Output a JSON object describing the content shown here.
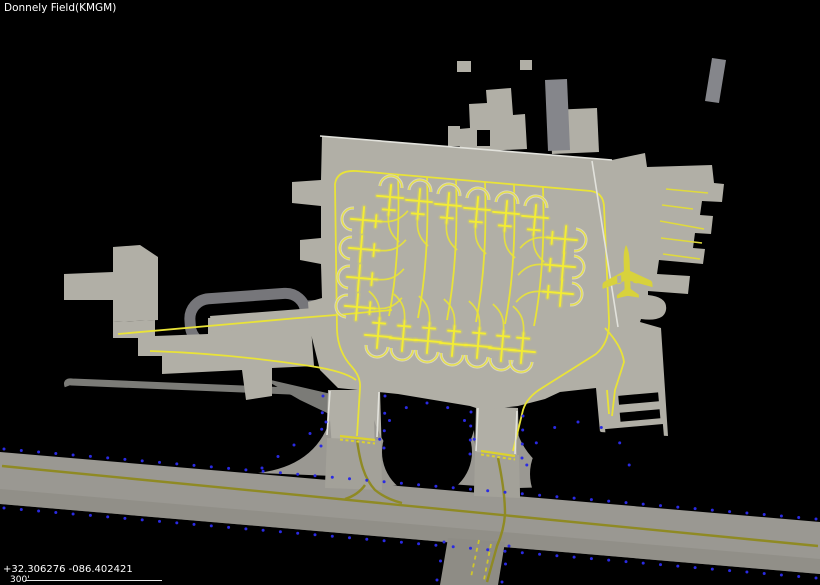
{
  "header": {
    "title": "Donnely Field(KMGM)"
  },
  "status": {
    "coordinates": "+32.306276 -086.402421",
    "scale_label": "300'"
  },
  "map": {
    "colors": {
      "background": "#000000",
      "apron": "#b1afa6",
      "taxiway": "#9a9892",
      "road": "#76767a",
      "line_yellow": "#e9e338",
      "line_olive": "#8f8a24",
      "edge_white": "#e2e2dc",
      "lights_blue": "#2a2ae2",
      "aircraft": "#d8d23c",
      "terminal_dark": "#85868b"
    },
    "aircraft_marker": {
      "x": 627,
      "y": 272,
      "rotate": -2
    },
    "stands": [
      {
        "name": "north-row",
        "angle": 5,
        "positions": [
          [
            391,
            186
          ],
          [
            420,
            190
          ],
          [
            449,
            194
          ],
          [
            478,
            198
          ],
          [
            507,
            202
          ],
          [
            536,
            206
          ]
        ]
      },
      {
        "name": "west-column",
        "angle": -85,
        "positions": [
          [
            352,
            219
          ],
          [
            350,
            248
          ],
          [
            348,
            277
          ],
          [
            346,
            306
          ]
        ]
      },
      {
        "name": "south-row",
        "angle": 185,
        "positions": [
          [
            377,
            347
          ],
          [
            402,
            350
          ],
          [
            427,
            352
          ],
          [
            452,
            355
          ],
          [
            477,
            357
          ],
          [
            501,
            360
          ],
          [
            521,
            362
          ]
        ]
      },
      {
        "name": "east-column",
        "angle": 95,
        "positions": [
          [
            576,
            240
          ],
          [
            574,
            267
          ],
          [
            572,
            294
          ]
        ]
      }
    ],
    "tie_down_lines": [
      [
        666,
        189,
        708,
        193
      ],
      [
        662,
        205,
        693,
        209
      ],
      [
        660,
        221,
        704,
        229
      ],
      [
        661,
        238,
        702,
        243
      ],
      [
        663,
        254,
        700,
        259
      ]
    ],
    "hold_lines": [
      [
        340,
        436,
        375,
        440
      ],
      [
        481,
        451,
        515,
        456
      ]
    ],
    "light_runs": {
      "lines": [
        [
          4,
          449,
          816,
          519,
          48
        ],
        [
          4,
          508,
          816,
          578,
          48
        ],
        [
          323,
          396,
          321,
          446,
          4
        ],
        [
          385,
          396,
          384,
          448,
          4
        ],
        [
          471,
          412,
          470,
          454,
          4
        ],
        [
          523,
          416,
          522,
          458,
          4
        ],
        [
          444,
          542,
          437,
          580,
          3
        ],
        [
          509,
          546,
          502,
          582,
          3
        ],
        [
          262,
          468,
          326,
          422,
          5
        ]
      ],
      "arcs": [
        [
          427,
          452,
          49,
          -165,
          -15,
          7
        ],
        [
          578,
          474,
          52,
          -170,
          -10,
          7
        ]
      ]
    }
  }
}
